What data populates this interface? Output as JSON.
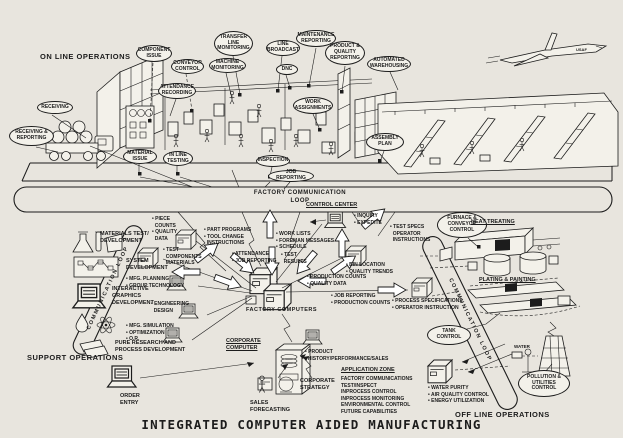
{
  "title": "INTEGRATED COMPUTER AIDED MANUFACTURING",
  "sections": {
    "on_line": "ON LINE OPERATIONS",
    "support": "SUPPORT OPERATIONS",
    "off_line": "OFF LINE OPERATIONS"
  },
  "loops": {
    "factory": "FACTORY COMMUNICATION\nLOOP",
    "left": "COMMUNICATION LOOP",
    "right": "COMMUNICATION LOOP"
  },
  "ovals": {
    "receiving": "RECEIVING",
    "receiving_reporting": "RECEIVING &\nREPORTING",
    "component_issue": "COMPONENT\nISSUE",
    "conveyor_control": "CONVEYOR\nCONTROL",
    "attendance_recording": "ATTENDANCE\nRECORDING",
    "machine_monitoring": "MACHINE\nMONITORING",
    "transfer_line_monitoring": "TRANSFER\nLINE\nMONITORING",
    "line_broadcast": "LINE\nBROADCAST",
    "maintenance_reporting": "MAINTENANCE\nREPORTING",
    "dnc": "DNC",
    "product_quality_reporting": "PRODUCT &\nQUALITY\nREPORTING",
    "automated_warehousing": "AUTOMATED\nWAREHOUSING",
    "work_assignments": "WORK\nASSIGNMENTS",
    "material_issue": "MATERIAL\nISSUE",
    "in_line_testing": "IN LINE\nTESTING",
    "inspection": "INSPECTION",
    "job_reporting": "JOB REPORTING",
    "assembly_plan": "ASSEMBLY\nPLAN",
    "furnace_conveyor_control": "FURNACE &\nCONVEYOR\nCONTROL",
    "tank_control": "TANK\nCONTROL",
    "pollution_utilities_control": "POLLUTION &\nUTILITIES\nCONTROL"
  },
  "bullets": {
    "piece_counts": "• PIECE\n  COUNTS\n• QUALITY\n  DATA",
    "part_programs": "• PART PROGRAMS\n• TOOL CHANGE\n  INSTRUCTIONS",
    "test_components": "• TEST\n  COMPONENTS\n  MATERIALS",
    "mfg_planning": "• MFG. PLANNING\n• GROUP TECHNOLOGY",
    "engineering_design": "• ENGINEERING\n  DESIGN",
    "mfg_simulation": "• MFG. SIMULATION\n• OPTIMIZATION\n• O.R.",
    "attendance_job": "• ATTENDANCE\n• JOB REPORTING",
    "inquiry_expedite": "• INQUIRY\n• EXPEDITE",
    "work_lists": "• WORK LISTS\n• FOREMAN MESSAGES\n• SCHEDULE",
    "test_results": "• TEST\n  RESULTS",
    "test_specs": "• TEST SPECS\n  OPERATOR\n  INSTRUCTIONS",
    "bin_location": "• BIN LOCATION\n• QUALITY TRENDS",
    "production_counts": "• PRODUCTION COUNTS\n• QUALITY DATA",
    "job_reporting_counts": "• JOB REPORTING\n• PRODUCTION COUNTS",
    "process_specs": "• PROCESS SPECIFICATIONS\n• OPERATOR INSTRUCTION",
    "product_history": "• PRODUCT\n  HISTORY/PERFORMANCE/SALES",
    "water_purity": "• WATER PURITY\n• AIR QUALITY CONTROL\n• ENERGY UTILIZATION"
  },
  "captions": {
    "control_center": "CONTROL CENTER",
    "factory_computers": "FACTORY COMPUTERS",
    "corporate_computer": "CORPORATE\nCOMPUTER",
    "order_entry": "ORDER\nENTRY",
    "sales_forecasting": "SALES\nFORECASTING",
    "corporate_strategy": "CORPORATE\nSTRATEGY",
    "heat_treating": "HEAT TREATING",
    "plating_painting": "PLATING & PAINTING",
    "water": "WATER",
    "usaf": "USAF",
    "application_zone_title": "APPLICATION ZONE",
    "application_zone_items": "FACTORY COMMUNICATIONS\nTEST/INSPECT\nINPROCESS CONTROL\nINPROCESS MONITORING\nENVIRONMENTAL CONTROL\nFUTURE CAPABILITIES"
  },
  "support": {
    "materials_test": "MATERIALS TEST/\nDEVELOPMENT",
    "system_development": "SYSTEM\nDEVELOPMENT",
    "interactive_graphics": "INTERACTIVE\nGRAPHICS\nDEVELOPMENT",
    "pure_research": "PURE RESEARCH AND\nPROCESS DEVELOPMENT"
  }
}
